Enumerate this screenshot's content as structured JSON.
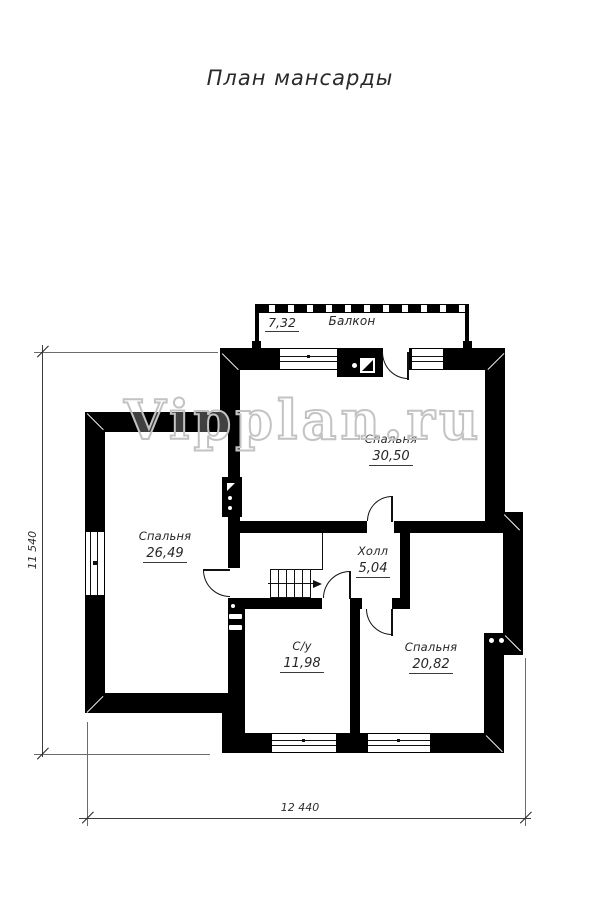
{
  "title": "План мансарды",
  "watermark": "Vipplan.ru",
  "balcony": {
    "name": "Балкон",
    "area": "7,32"
  },
  "rooms": [
    {
      "name": "Спальня",
      "area": "30,50"
    },
    {
      "name": "Спальня",
      "area": "26,49"
    },
    {
      "name": "Холл",
      "area": "5,04"
    },
    {
      "name": "С/у",
      "area": "11,98"
    },
    {
      "name": "Спальня",
      "area": "20,82"
    }
  ],
  "dimensions": {
    "horizontal": "12 440",
    "vertical": "11 540"
  },
  "colors": {
    "wall": "#000000",
    "dimension_line": "#3c3c3c",
    "watermark_stroke": "#c3c3c3"
  }
}
